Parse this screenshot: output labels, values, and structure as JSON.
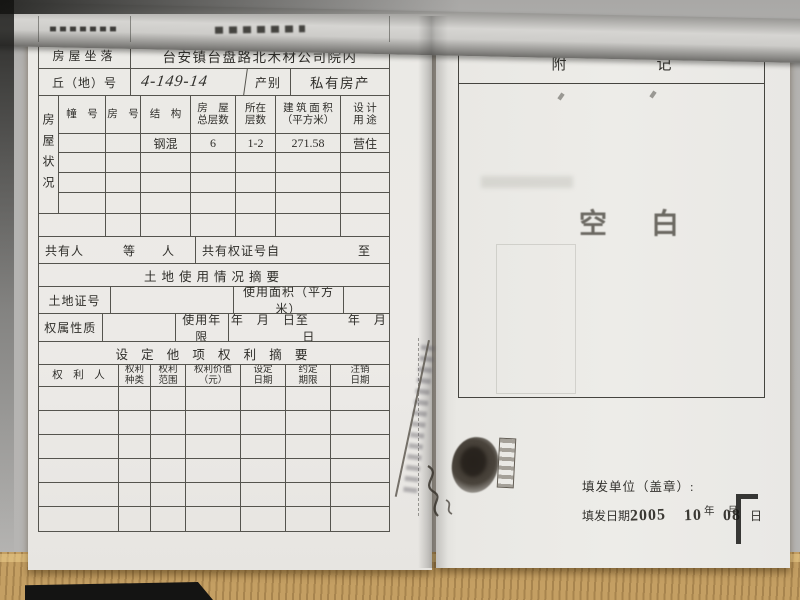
{
  "document_type": "房屋所有权证内页",
  "colors": {
    "paper": "#ebeae6",
    "ink": "#2f2e2a",
    "stamp_gray": "#504d46",
    "desk_wood": "#c49f63"
  },
  "left_page": {
    "address": {
      "label": "房屋坐落",
      "value": "台安镇台盘路北木材公司院内"
    },
    "plot": {
      "label": "丘（地）号",
      "value": "4-149-14",
      "category_label": "产别",
      "category_value": "私有房产"
    },
    "house_status": {
      "side_label": "房屋状况",
      "headers": [
        "幢　号",
        "房　号",
        "结　构",
        "房　屋\n总层数",
        "所在\n层数",
        "建 筑 面 积\n（平方米）",
        "设 计\n用 途"
      ],
      "row": {
        "building_no": "",
        "room_no": "",
        "structure": "钢混",
        "total_floors": "6",
        "floors": "1-2",
        "area": "271.58",
        "usage": "营住"
      }
    },
    "co_owner": {
      "left": "共有人　　　等　　人",
      "right": "共有权证号自　　　　　　至"
    },
    "land_title": "土地使用情况摘要",
    "land": {
      "cert_label": "土地证号",
      "area_label": "使用面积（平方米）"
    },
    "tenure": {
      "label": "权属性质",
      "years_label": "使用年限",
      "dates": "年　月　日至　　　年　月　日"
    },
    "rights_title": "设 定 他 项 权 利 摘 要",
    "rights_headers": [
      "权　利　人",
      "权利\n种类",
      "权利\n范围",
      "权利价值\n（元）",
      "设定\n日期",
      "约定\n期限",
      "注销\n日期"
    ]
  },
  "right_page": {
    "title": "附　　　　　　记",
    "blank_stamp": "空　白",
    "issuer_label": "填发单位（盖章）:",
    "date_label": "填发日期",
    "date_year": "2005",
    "date_month": "10",
    "date_day": "08",
    "unit_year": "年",
    "unit_month": "月",
    "unit_day": "日"
  }
}
